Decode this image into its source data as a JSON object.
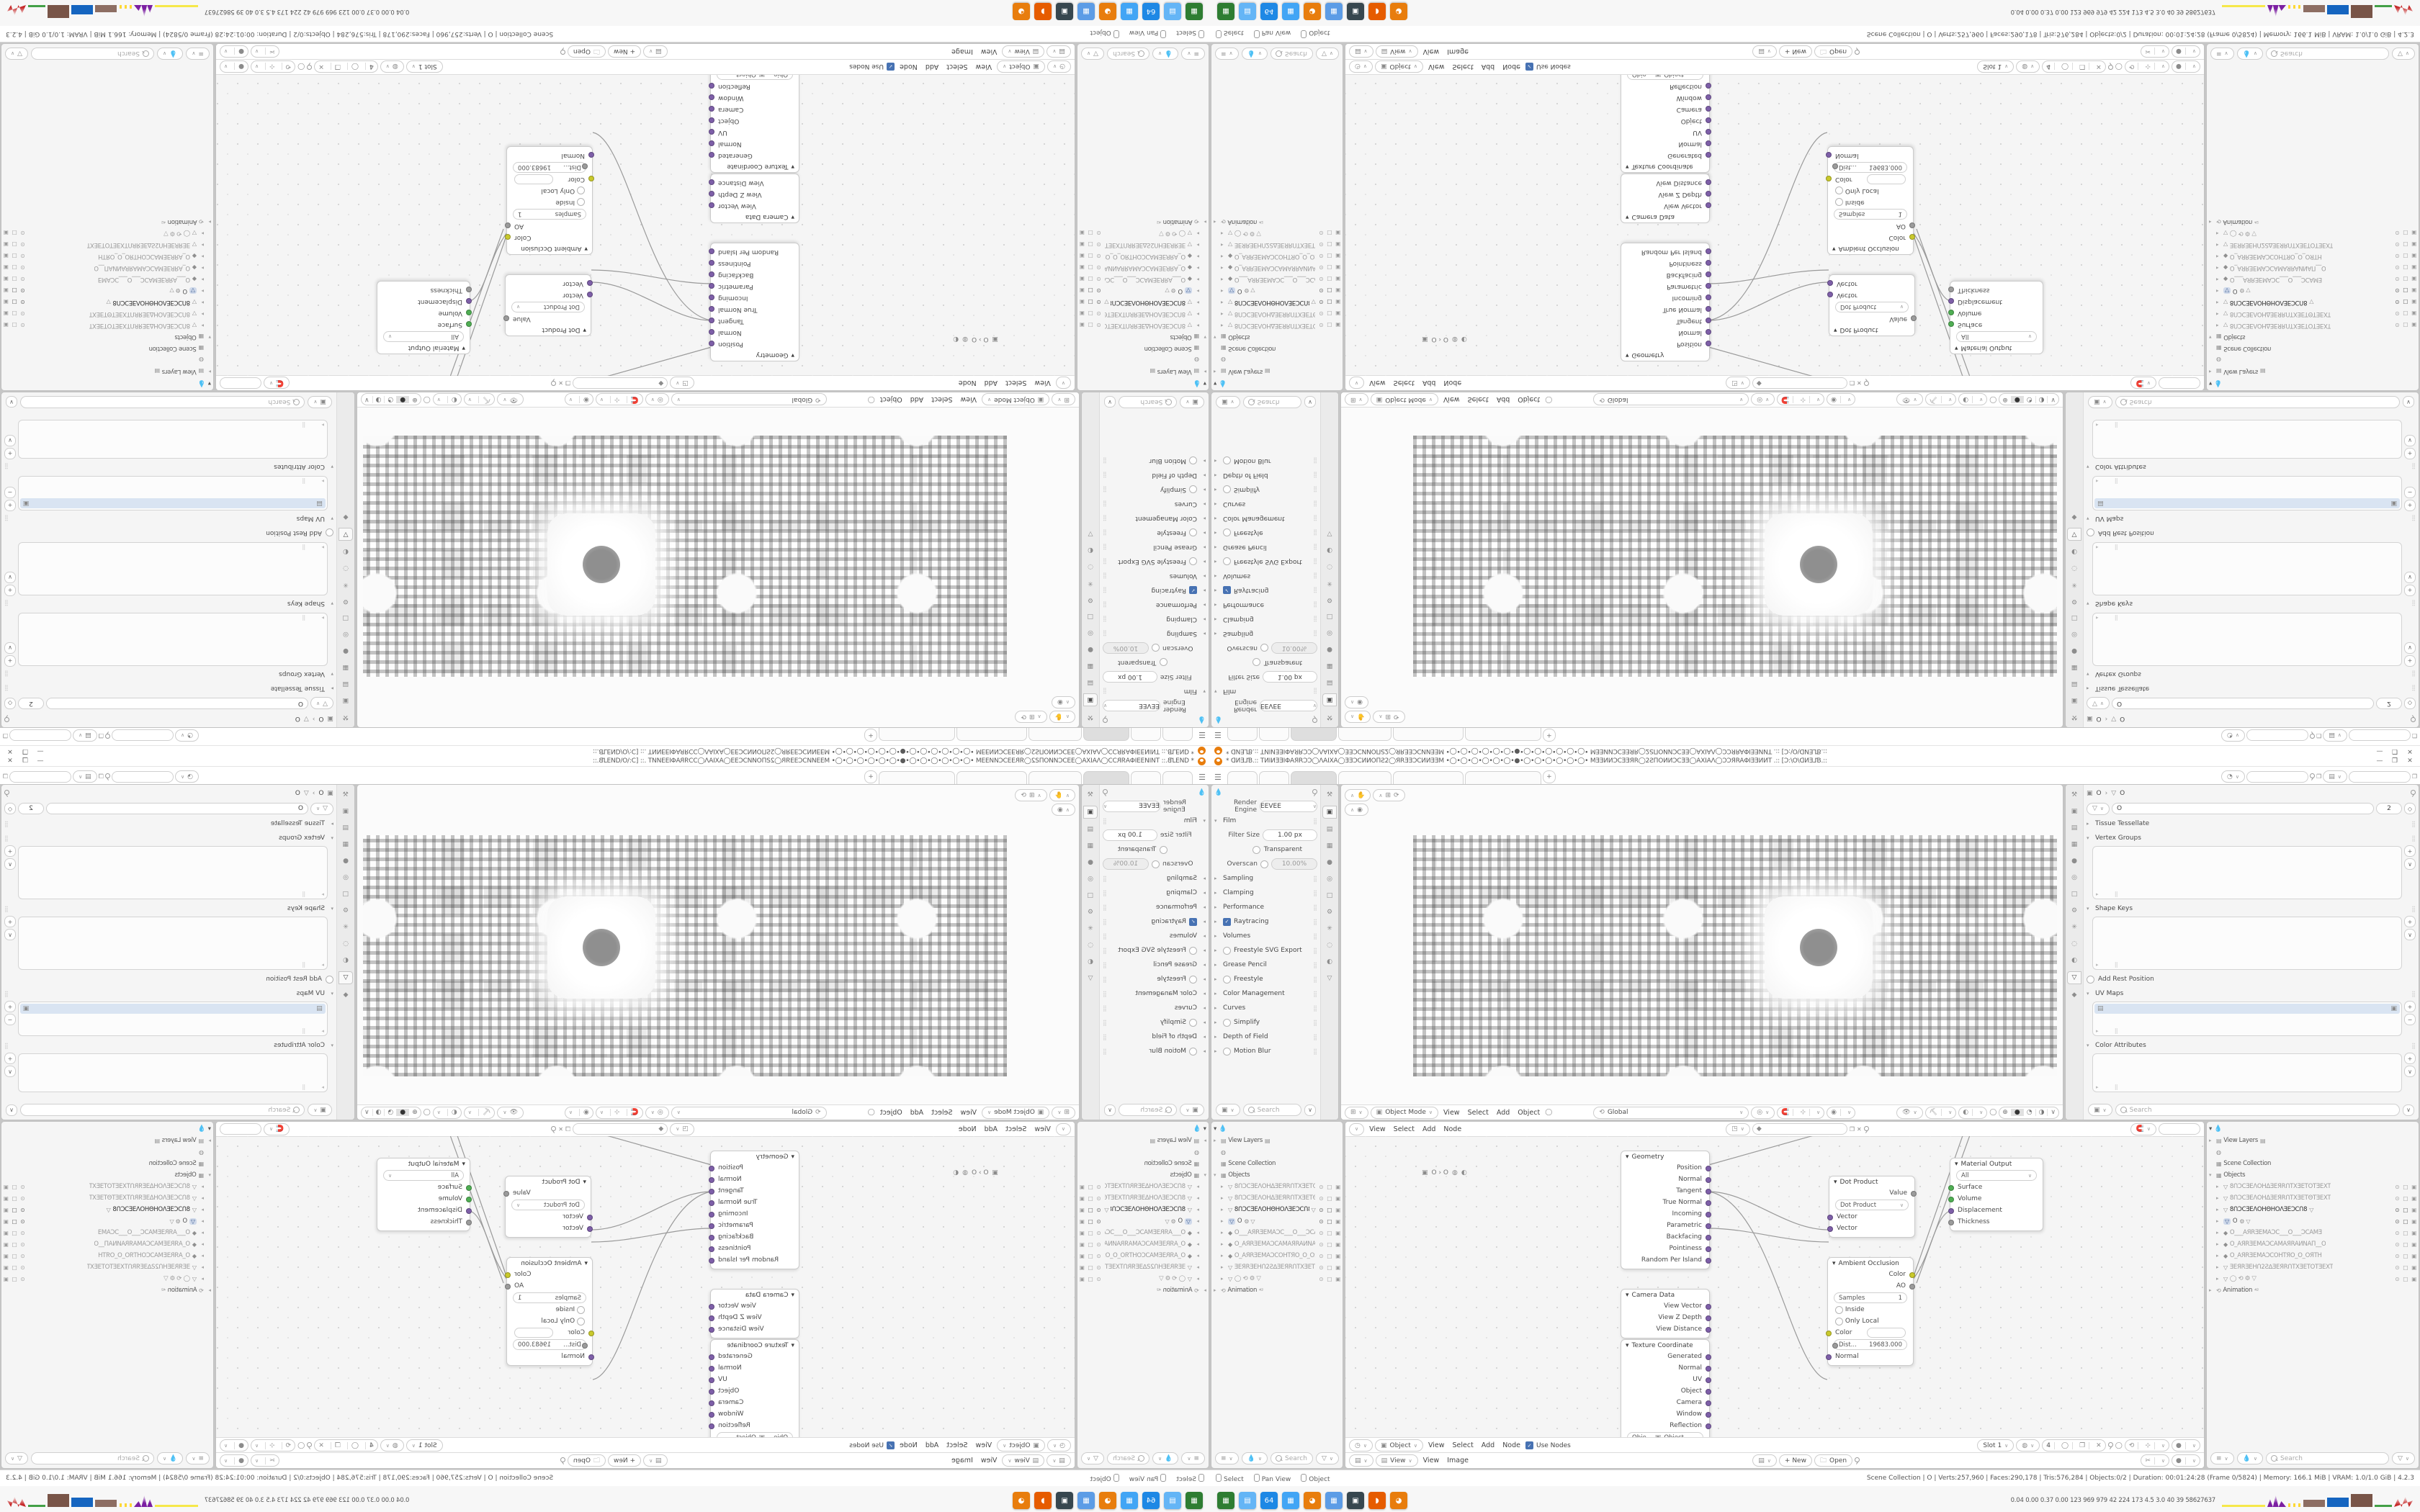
{
  "window": {
    "title": "* ᗡИƎ⅃Ɓ.:: TИIИƎƎIΦAЯRƆƆ◯ΛAIXA◯ƎƎƆCИИOΠƧ2◯ЯRƎƎƆCИИƎƎM •◯•◯•◯•◯•◯•◯•●•◯•◯•◯•◯•◯•◯• MƎƎИИƆCƎƎЯR◯2ƧΠOИИƆCƎƎ◯AXIAΛ◯ƆƆЯRAΦIƎƎИИT .:: [Ɔ:\\O\\ᗡИƎ⅃Ɓ.::",
    "minimize": "—",
    "maximize": "❐",
    "close": "✕",
    "add_tab": "+"
  },
  "render_props": {
    "engine_label": "Render Engine",
    "engine_value": "EEVEE",
    "film_title": "Film",
    "filter_label": "Filter Size",
    "filter_value": "1.00 px",
    "transparent_label": "Transparent",
    "overscan_label": "Overscan",
    "overscan_value": "10.00%",
    "sections": [
      {
        "label": "Sampling"
      },
      {
        "label": "Clamping"
      },
      {
        "label": "Performance"
      },
      {
        "label": "Raytracing",
        "ctrl": "check"
      },
      {
        "label": "Volumes"
      },
      {
        "label": "Freestyle SVG Export",
        "ctrl": "radio"
      },
      {
        "label": "Grease Pencil"
      },
      {
        "label": "Freestyle",
        "ctrl": "radio"
      },
      {
        "label": "Color Management"
      },
      {
        "label": "Curves"
      },
      {
        "label": "Simplify",
        "ctrl": "radio"
      },
      {
        "label": "Depth of Field"
      },
      {
        "label": "Motion Blur",
        "ctrl": "radio"
      }
    ],
    "search_placeholder": "Search"
  },
  "data_props": {
    "breadcrumb_object": "O",
    "breadcrumb_data": "O",
    "name_value": "O",
    "user_count": "2",
    "tissue_label": "Tissue Tessellate",
    "vertex_groups_label": "Vertex Groups",
    "shape_keys_label": "Shape Keys",
    "rest_label": "Add Rest Position",
    "uv_maps_label": "UV Maps",
    "color_attrs_label": "Color Attributes",
    "search_placeholder": "Search"
  },
  "viewport": {
    "mode": "Object Mode",
    "menus": [
      "View",
      "Select",
      "Add",
      "Object"
    ],
    "orientation": "Global"
  },
  "node_editor": {
    "menus": [
      "View",
      "Select",
      "Add",
      "Node"
    ],
    "breadcrumb": "O  ›  O",
    "nodes": {
      "geometry": {
        "title": "Geometry",
        "outputs": [
          "Position",
          "Normal",
          "Tangent",
          "True Normal",
          "Incoming",
          "Parametric",
          "Backfacing",
          "Pointiness",
          "Random Per Island"
        ]
      },
      "camera_data": {
        "title": "Camera Data",
        "outputs": [
          "View Vector",
          "View Z Depth",
          "View Distance"
        ]
      },
      "texcoord": {
        "title": "Texture Coordinate",
        "outputs": [
          "Generated",
          "Normal",
          "UV",
          "Object",
          "Camera",
          "Window",
          "Reflection"
        ],
        "object_label": "Obje...",
        "object_value": "Object",
        "instancer_label": "From Instancer"
      },
      "dot": {
        "title": "Dot Product",
        "value_label": "Value",
        "op_value": "Dot Product",
        "inputs": [
          "Vector",
          "Vector"
        ]
      },
      "ao": {
        "title": "Ambient Occlusion",
        "color_out": "Color",
        "ao_out": "AO",
        "samples_label": "Samples",
        "samples_value": "1",
        "inside_label": "Inside",
        "only_local_label": "Only Local",
        "color_in": "Color",
        "dist_label": "Dist...",
        "dist_value": "19683.000",
        "normal_label": "Normal"
      },
      "output": {
        "title": "Material Output",
        "target_value": "All",
        "inputs": [
          "Surface",
          "Volume",
          "Displacement",
          "Thickness"
        ]
      }
    },
    "footer": {
      "object_value": "Object",
      "menus": [
        "View",
        "Select",
        "Add",
        "Node"
      ],
      "use_nodes": "Use Nodes",
      "slot_value": "Slot 1",
      "image_name": "4"
    }
  },
  "image_editor": {
    "view_value": "View",
    "menus": [
      "View",
      "Image"
    ],
    "new_label": "+ New",
    "open_label": "Open"
  },
  "outliner": {
    "view_layers": "View Layers",
    "scene_collection": "Scene Collection",
    "objects": "Objects",
    "items": [
      {
        "icon": "mesh",
        "label": "8ՈƆCƎEΛOHΔƎEЯRՈTXƎETOTƎEXT",
        "state": "dim"
      },
      {
        "icon": "mesh",
        "label": "8ՈƆCƎEΛOHΔƎEЯRՈTXƎETΘTƎEXT",
        "state": "dim"
      },
      {
        "icon": "mesh",
        "label": "8ՈƆCƎEΛOHΘHOΛƎEƆCՈ8",
        "state": "active",
        "extra": "▽"
      },
      {
        "icon": "mesh-sel",
        "label": "O",
        "state": "selected",
        "extra": "⚙ ▽"
      },
      {
        "icon": "camera",
        "label": "O___AЯRƎEMAƆC___O___ƆCAMƎ",
        "state": "dim"
      },
      {
        "icon": "camera",
        "label": "O_AЯRƎEMAƆCAMAЯRAИNAΠ__O",
        "state": "dim"
      },
      {
        "icon": "camera",
        "label": "O_AЯRƎEMAƆCOHTЯO_O_OЯTH",
        "state": "dim"
      },
      {
        "icon": "mesh",
        "label": "ƎEЯRƎEHՈ2Ƨ∆ƎEЯRՈTXƎETOTƎEXT",
        "state": "dim"
      },
      {
        "icon": "mesh",
        "label": "◯  ⟲ ⚙ ▽",
        "state": "dim"
      }
    ],
    "animation_label": "Animation",
    "animation_badge": "⁴²",
    "search_placeholder": "Search"
  },
  "status_bar": {
    "hints": [
      "Select",
      "Pan View",
      "Object"
    ],
    "info": "Scene Collection  |  O  |  Verts:257,960  |  Faces:290,178  |  Tris:576,284  |  Objects:0/2  |  Duration: 00:01:24:28 (Frame 0/5824)  |  Memory: 166.1 MiB  |  VRAM: 1.0/1.0 GiB  |  4.2.3"
  },
  "taskbar": {
    "apps": [
      {
        "name": "file-manager",
        "color": "#2e7d32",
        "glyph": "▦"
      },
      {
        "name": "text-editor",
        "color": "#64b5f6",
        "glyph": "▤"
      },
      {
        "name": "save-64",
        "color": "#1e88e5",
        "glyph": "64"
      },
      {
        "name": "calculator",
        "color": "#42a5f5",
        "glyph": "▦"
      },
      {
        "name": "blender",
        "color": "#e87d0d",
        "glyph": "◕"
      },
      {
        "name": "calculator-2",
        "color": "#5c9ce6",
        "glyph": "▦"
      },
      {
        "name": "image-viewer",
        "color": "#37474f",
        "glyph": "▣"
      },
      {
        "name": "firefox",
        "color": "#e65c00",
        "glyph": "◗"
      },
      {
        "name": "blender-2",
        "color": "#e87d0d",
        "glyph": "◕"
      }
    ],
    "tray_text": "0.04 0.00 0.37 0.00  123  969  979  42  224  173  4.5  3.0  40  39  58627637"
  },
  "colors": {
    "accent": "#4772b3",
    "socket_purple": "#7e5fa8",
    "socket_yellow": "#c9c92c",
    "socket_green": "#4fae53",
    "socket_gray": "#9b9b9b",
    "logo_orange": "#e87d0d"
  }
}
